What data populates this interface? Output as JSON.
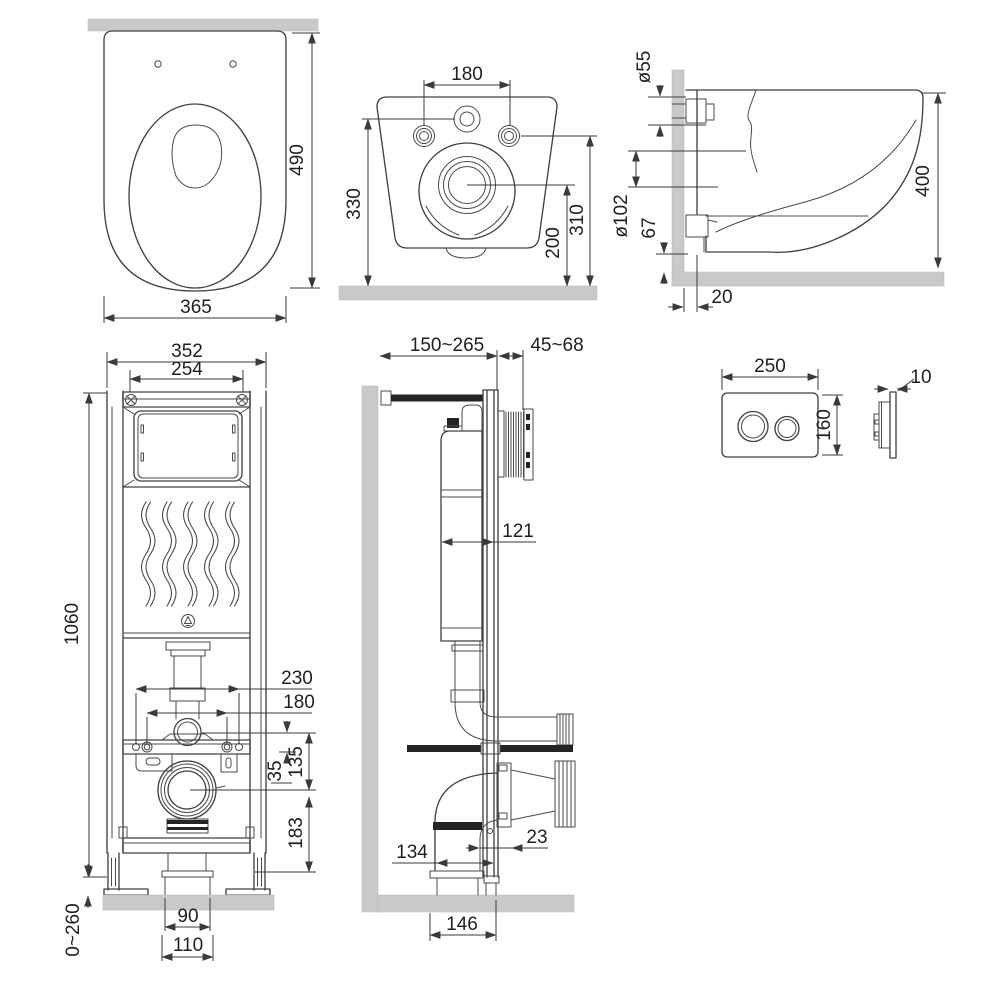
{
  "drawing": {
    "type": "technical-installation-drawing",
    "subject": "wall-hung toilet with concealed cistern frame and flush plate"
  },
  "dims": {
    "top_view": {
      "depth": "490",
      "width": "365"
    },
    "back_view": {
      "bolt_spacing": "180",
      "height": "330",
      "bolt_height": "310",
      "outlet_center_height": "200"
    },
    "side_view": {
      "bolt_dia": "ø55",
      "outlet_dia": "ø102",
      "outlet_drop": "67",
      "depth": "400",
      "wall_gap": "20"
    },
    "frame_front": {
      "width": "352",
      "hanger_spacing": "254",
      "height": "1060",
      "outer_bolt_spacing": "230",
      "inner_bolt_spacing": "180",
      "dim_35": "35",
      "dim_135": "135",
      "dim_183": "183",
      "foot_adjust": "0~260",
      "drain_width": "90",
      "flange_width": "110"
    },
    "frame_side": {
      "depth_adjust": "150~265",
      "front_adjust": "45~68",
      "cistern_depth": "121",
      "dim_134": "134",
      "dim_23": "23",
      "dim_146": "146"
    },
    "flush_plate": {
      "width": "250",
      "height": "160",
      "thickness": "10"
    }
  },
  "colors": {
    "line": "#424242",
    "dim_line": "#3a3a3a",
    "text": "#1f1f1f",
    "wall_fill": "#c9c9c9",
    "pipe_dark": "#242424",
    "background": "#ffffff"
  }
}
